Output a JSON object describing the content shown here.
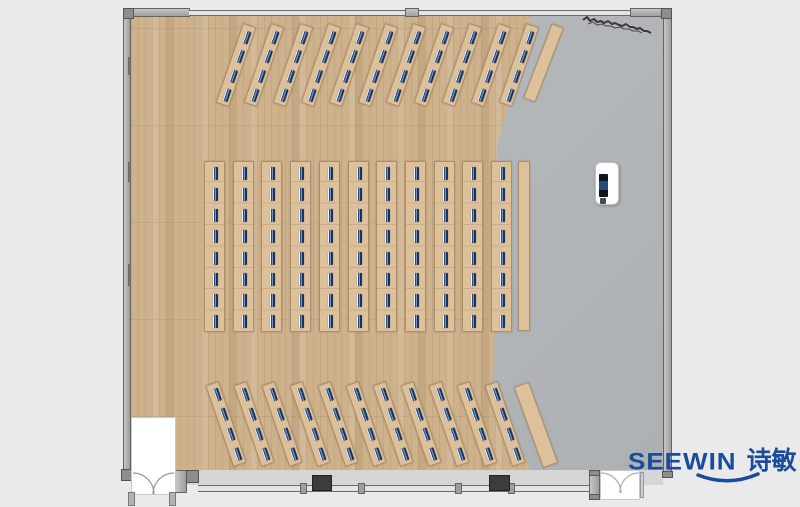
{
  "brand": {
    "latin": "SEEWIN",
    "chinese": "诗敏",
    "color": "#1a4b9d"
  },
  "palette": {
    "background": "#eaeaea",
    "wood_floor": "#cdb28c",
    "concrete_floor": "#b4b8bb",
    "desk_top": "#dcc19b",
    "desk_edge": "#b99a6f",
    "seat_navy": "#1c3157",
    "seat_blue": "#6f97c9",
    "wall_gray": "#b3b3b3",
    "wall_outline": "#636363",
    "window_fill": "#e4e4e4",
    "column_dark": "#3c3c3c",
    "door_white": "#ffffff",
    "sketch": "#3a3a3a"
  },
  "floorplan": {
    "total_desks": 33,
    "total_seats": 176,
    "side_tables": 3,
    "groups": [
      {
        "name": "front-angled-rows",
        "desks": 11,
        "seats_per_desk": 4,
        "orientation_deg": 19,
        "cx0": 236,
        "cy": 65,
        "dx": 28.3,
        "w": 14,
        "h": 84,
        "side_table": {
          "cx": 543,
          "cy": 63,
          "w": 13,
          "h": 80,
          "rot": 21
        }
      },
      {
        "name": "center-straight-rows",
        "desks": 11,
        "seats_per_desk": 8,
        "orientation_deg": 0,
        "x0": 204,
        "y": 161,
        "dx": 28.7,
        "w": 21,
        "h": 171,
        "side_table": {
          "cx": 524,
          "cy": 246,
          "w": 12,
          "h": 170,
          "rot": 0
        }
      },
      {
        "name": "rear-angled-rows",
        "desks": 11,
        "seats_per_desk": 4,
        "orientation_deg": -19,
        "cx0": 226,
        "cy": 424,
        "dx": 27.9,
        "w": 14,
        "h": 86,
        "side_table": {
          "cx": 536,
          "cy": 425,
          "w": 16,
          "h": 86,
          "rot": -20
        }
      }
    ]
  }
}
